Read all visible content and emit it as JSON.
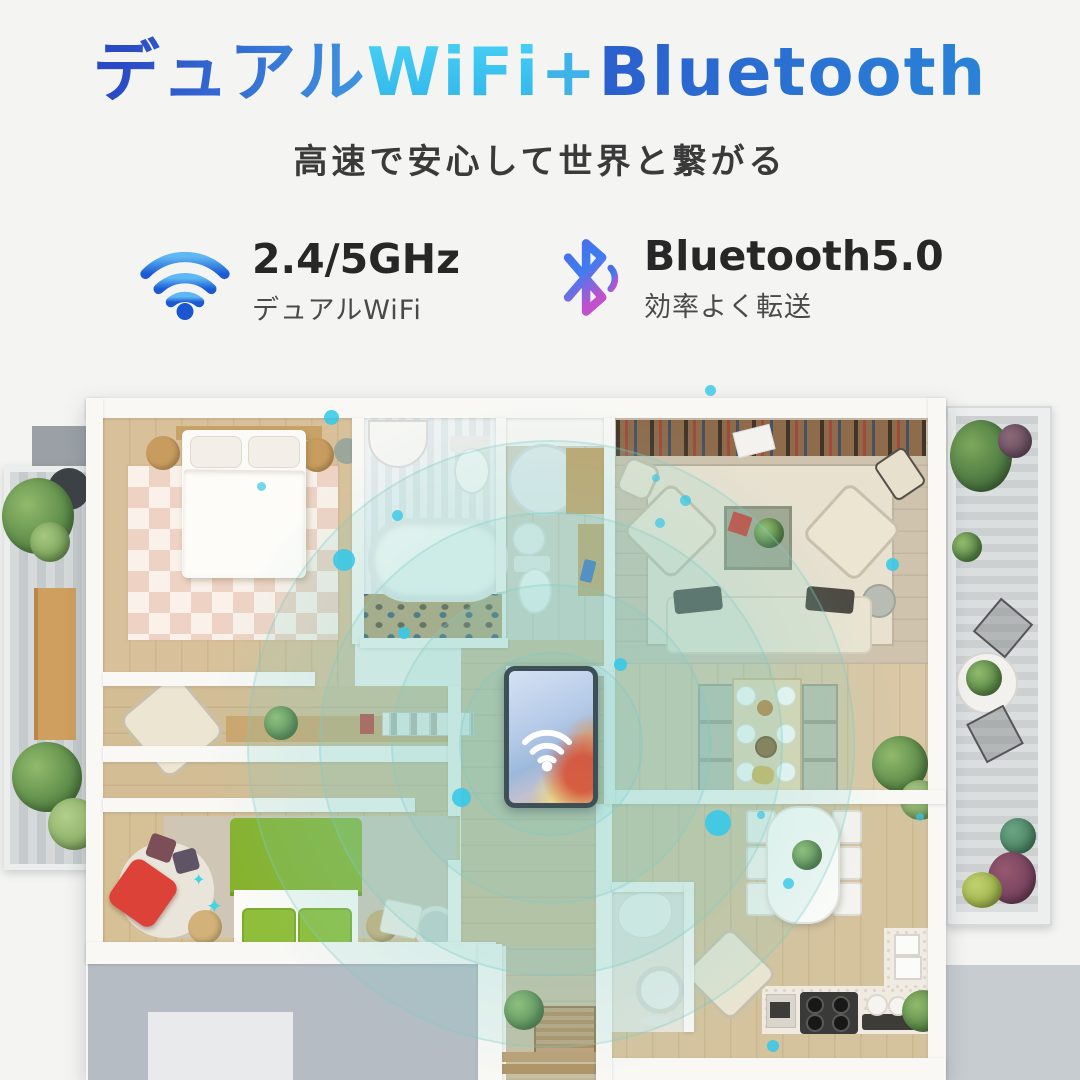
{
  "header": {
    "title_segments": [
      {
        "text": "デュアル",
        "color": "#2f5ccc → #3f93e0"
      },
      {
        "text": "WiFi",
        "color": "#3ec7f2"
      },
      {
        "text": "+",
        "color": "#3fb2e8"
      },
      {
        "text": "Bluetooth",
        "color": "#2b6cd4"
      }
    ],
    "subtitle": "高速で安心して世界と繋がる"
  },
  "features": [
    {
      "id": "wifi",
      "title": "2.4/5GHz",
      "subtitle": "デュアルWiFi",
      "icon": "wifi-icon"
    },
    {
      "id": "bluetooth",
      "title": "Bluetooth5.0",
      "subtitle": "効率よく転送",
      "icon": "bluetooth-icon"
    }
  ],
  "misc": {
    "sparkle_glyph": "✦"
  },
  "colors": {
    "background": "#f4f4f2",
    "title_blue_dark": "#2a49c6",
    "title_cyan": "#3ec7f2",
    "title_blue": "#2b6cd4",
    "subtitle_text": "#3a3a3a",
    "wifi_icon_gradient_top": "#5fb7f4",
    "wifi_icon_gradient_bottom": "#1b5ad2",
    "bluetooth_icon_gradient_top": "#4a6bec",
    "bluetooth_icon_gradient_bottom": "#c250cc",
    "signal_ring": "#7ccdc6",
    "signal_dot": "#35c8e8",
    "wall_white": "#f9f8f5",
    "wood_floor": "#d8c19a",
    "balcony_gray": "#c5cacc",
    "bed_green": "#86b22d",
    "chair_red": "#dc4237",
    "sofa_cream": "#ece5d2",
    "tablet_frame": "#3d5058"
  }
}
